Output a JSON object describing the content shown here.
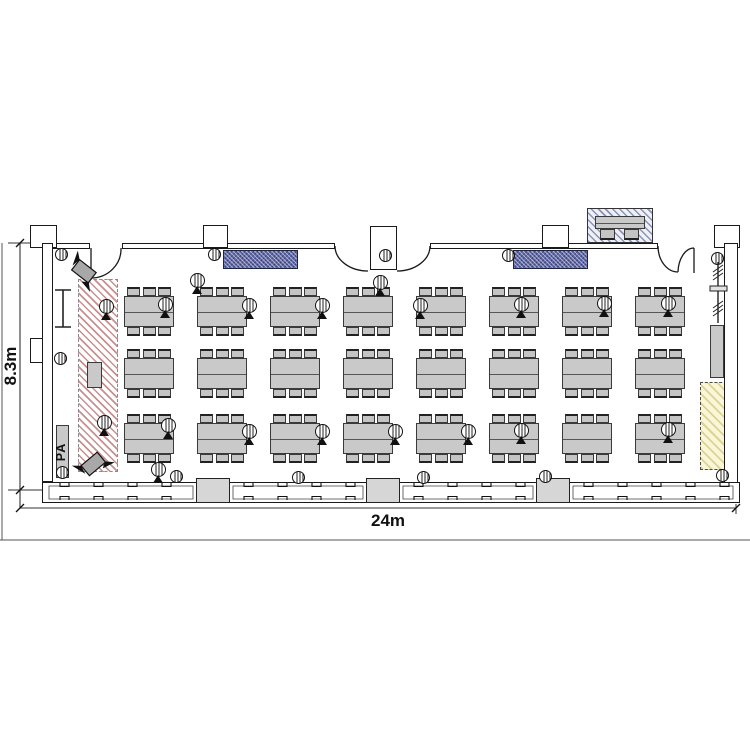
{
  "diagram": {
    "type": "banquet-hall-floor-plan",
    "dimension_labels": {
      "width": "24m",
      "height": "8.3m"
    },
    "pa_label": "PA",
    "furniture_summary": {
      "table_groups": 24,
      "table_rows": 3,
      "table_columns": 8,
      "chairs_per_table": 6,
      "total_chairs_at_tables": 144,
      "registration_tables": 1,
      "registration_chairs": 2
    },
    "equipment_summary": {
      "table_microphones": 14,
      "floor_microphones": 3,
      "stage_microphones": 2,
      "wall_speakers": 11,
      "tripod_speakers": 2,
      "wall_screens": 2,
      "doors": 4
    },
    "zones": {
      "stage": "stage-area",
      "pa_desk": "pa-desk",
      "registration": "registration-desk",
      "reserved_corner": "reserved-corner-area"
    },
    "icons": {
      "microphone": "circle-with-grille-and-tripod-base",
      "wall_speaker": "circle-with-grille",
      "tripod_speaker": "rotated-box-with-stand",
      "screen": "blue-crosshatched-rectangle"
    },
    "colors": {
      "line": "#1a1a1a",
      "table_gray": "#c9c9c9",
      "stage_hatch": "#c98f8f",
      "screen_blue": "#5f68a8",
      "reserved_yellow": "#faf6d8",
      "registration_hatch": "#8a92b8"
    }
  }
}
